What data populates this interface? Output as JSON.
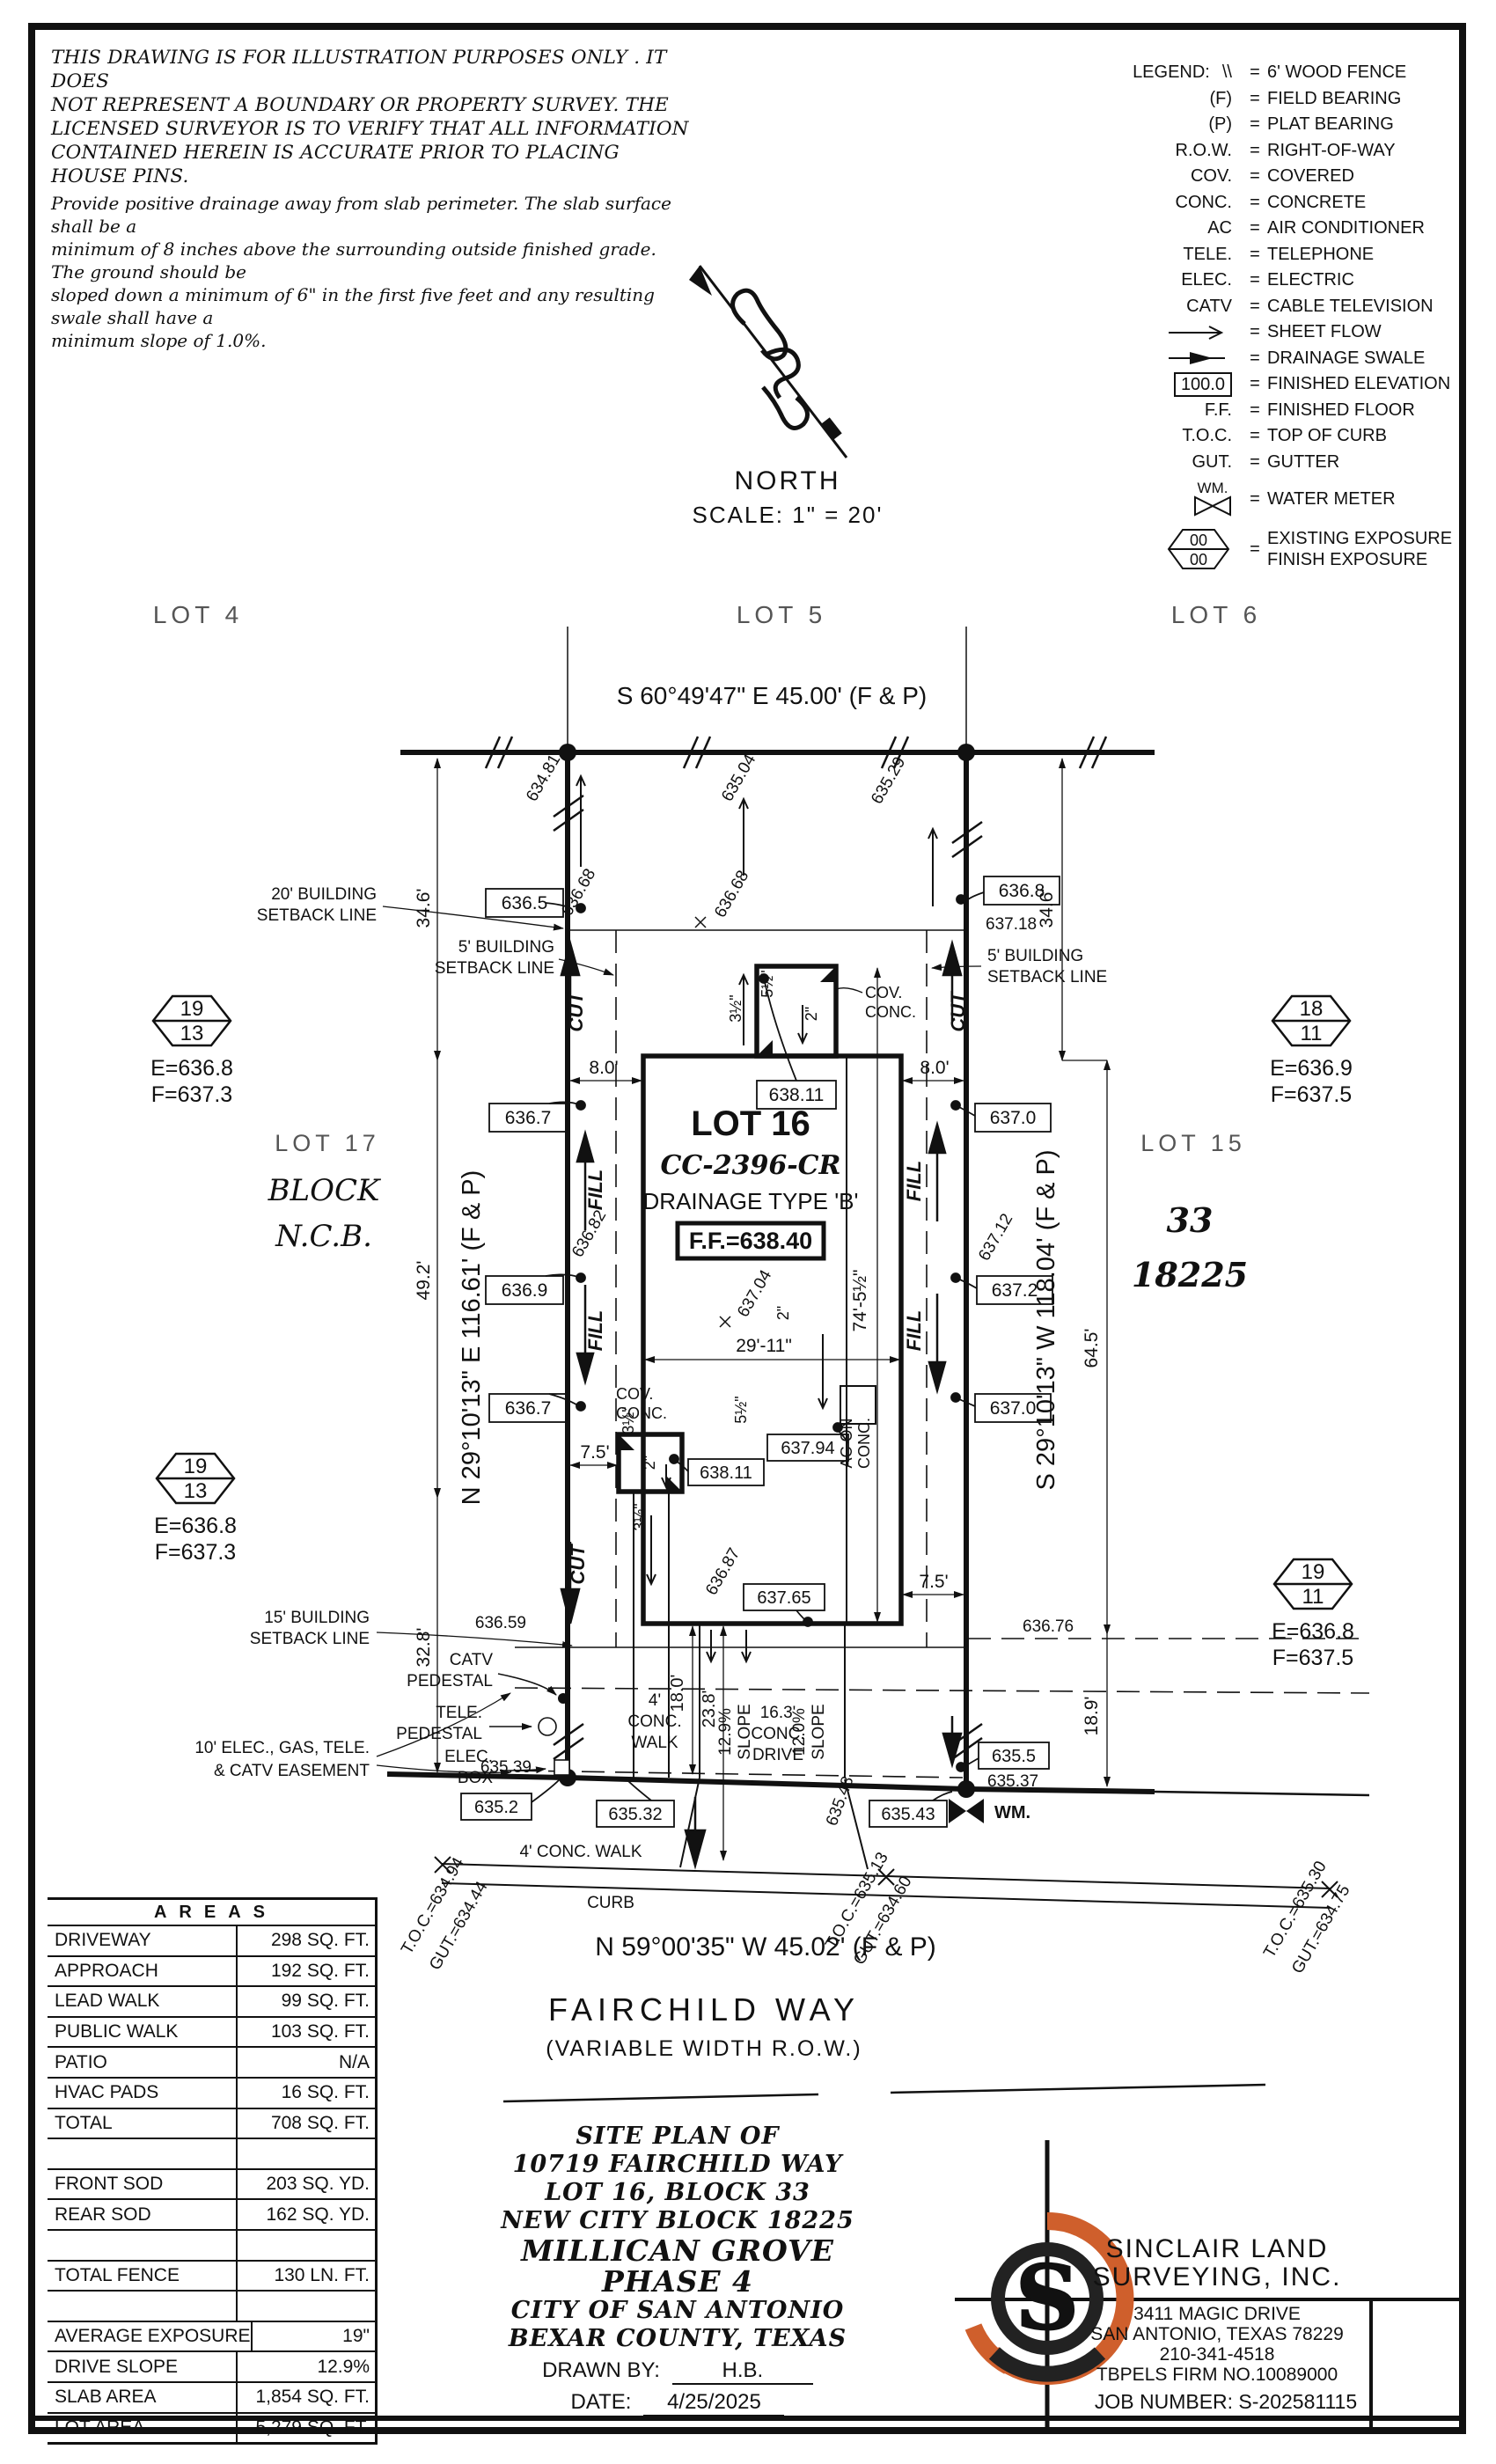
{
  "disclaimer": {
    "p1": [
      "THIS DRAWING IS FOR ILLUSTRATION PURPOSES ONLY . IT DOES",
      "NOT REPRESENT A BOUNDARY OR PROPERTY SURVEY. THE",
      "LICENSED SURVEYOR IS TO VERIFY THAT ALL INFORMATION",
      "CONTAINED HEREIN IS ACCURATE PRIOR TO PLACING HOUSE PINS."
    ],
    "p2": [
      "Provide positive drainage away from slab perimeter. The slab surface shall be a",
      "minimum of 8 inches above the surrounding outside finished grade. The ground should be",
      "sloped down a minimum of 6\" in the first five feet and any resulting swale shall have a",
      "minimum slope of 1.0%."
    ]
  },
  "legend": {
    "title": "LEGEND:",
    "eq": "=",
    "rows1": [
      {
        "sym": "\\\\",
        "desc": "6' WOOD FENCE"
      },
      {
        "sym": "(F)",
        "desc": "FIELD BEARING"
      },
      {
        "sym": "(P)",
        "desc": "PLAT BEARING"
      },
      {
        "sym": "R.O.W.",
        "desc": "RIGHT-OF-WAY"
      },
      {
        "sym": "COV.",
        "desc": "COVERED"
      },
      {
        "sym": "CONC.",
        "desc": "CONCRETE"
      },
      {
        "sym": "AC",
        "desc": "AIR CONDITIONER"
      },
      {
        "sym": "TELE.",
        "desc": "TELEPHONE"
      },
      {
        "sym": "ELEC.",
        "desc": "ELECTRIC"
      },
      {
        "sym": "CATV",
        "desc": "CABLE TELEVISION"
      }
    ],
    "flow_desc": "SHEET FLOW",
    "swale_desc": "DRAINAGE SWALE",
    "elev_sym": "100.0",
    "elev_desc": "FINISHED ELEVATION",
    "rows2": [
      {
        "sym": "F.F.",
        "desc": "FINISHED FLOOR"
      },
      {
        "sym": "T.O.C.",
        "desc": "TOP OF CURB"
      },
      {
        "sym": "GUT.",
        "desc": "GUTTER"
      }
    ],
    "wm_sym": "WM.",
    "wm_desc": "WATER METER",
    "hex_top": "00",
    "hex_bot": "00",
    "hex_desc1": "EXISTING EXPOSURE",
    "hex_desc2": "FINISH EXPOSURE"
  },
  "north": {
    "label": "NORTH",
    "scale": "SCALE: 1\" = 20'"
  },
  "adj": {
    "lot4": "LOT 4",
    "lot5": "LOT 5",
    "lot6": "LOT 6",
    "lot17": "LOT 17",
    "block": "BLOCK",
    "ncb": "N.C.B.",
    "lot15": "LOT 15",
    "b33": "33",
    "ncb2": "18225"
  },
  "brg": {
    "n": "S 60°49'47\" E 45.00' (F & P)",
    "w": "N 29°10'13\" E 116.61' (F & P)",
    "e": "S 29°10'13\" W 118.04' (F & P)",
    "s": "N 59°00'35\" W 45.02' (F & P)"
  },
  "hexm": {
    "nw": {
      "t": "19",
      "b": "13",
      "e": "E=636.8",
      "f": "F=637.3"
    },
    "ne": {
      "t": "18",
      "b": "11",
      "e": "E=636.9",
      "f": "F=637.5"
    },
    "sw": {
      "t": "19",
      "b": "13",
      "e": "E=636.8",
      "f": "F=637.3"
    },
    "se": {
      "t": "19",
      "b": "11",
      "e": "E=636.8",
      "f": "F=637.5"
    }
  },
  "lot": {
    "name": "LOT 16",
    "cc": "CC-2396-CR",
    "dr": "DRAINAGE TYPE 'B'",
    "ff": "F.F.=638.40"
  },
  "sb": {
    "b20": "20' BUILDING",
    "b5": "5' BUILDING",
    "b15": "15' BUILDING",
    "sl": "SETBACK LINE",
    "e1": "10' ELEC., GAS, TELE.",
    "e2": "& CATV EASEMENT"
  },
  "util": {
    "catv": "CATV",
    "ped": "PEDESTAL",
    "tele": "TELE.",
    "elec": "ELEC.",
    "box": "BOX",
    "wm": "WM."
  },
  "dims": {
    "d346": "34.6'",
    "d492": "49.2'",
    "d328": "32.8'",
    "d645": "64.5'",
    "d189": "18.9'",
    "d80": "8.0'",
    "d75": "7.5'",
    "hw": "29'-11\"",
    "hd": "74'-5½\"",
    "d180": "18.0'",
    "d238": "23.8'",
    "dr1": "16.3'",
    "dr2": "CONC.",
    "dr3": "DRIVE",
    "s129": "12.9%",
    "s120": "12.0%",
    "slw": "SLOPE",
    "w1": "4'",
    "w2": "CONC.",
    "w3": "WALK"
  },
  "sm": {
    "d2": "2\"",
    "d35": "3½\"",
    "d55": "5½\"",
    "cov": "COV.",
    "conc": "CONC.",
    "ac1": "AC ON",
    "ac2": "CONC."
  },
  "flow": {
    "cut": "CUT",
    "fill": "FILL"
  },
  "sp": {
    "e63481": "634.81",
    "e63504": "635.04",
    "e63529": "635.29",
    "e63668": "636.68",
    "e63682": "636.82",
    "e63712": "637.12",
    "e63704": "637.04",
    "e63687": "636.87",
    "e63548": "635.48",
    "e63659": "636.59",
    "e63676": "636.76",
    "e63718": "637.18",
    "e63539": "635.39",
    "e63537": "635.37"
  },
  "bx": {
    "b6365": "636.5",
    "b6367": "636.7",
    "b6369": "636.9",
    "b6368": "636.8",
    "b6370": "637.0",
    "b6372": "637.2",
    "b63811": "638.11",
    "b63794": "637.94",
    "b63765": "637.65",
    "b6352": "635.2",
    "b63532": "635.32",
    "b63543": "635.43",
    "b6355": "635.5"
  },
  "toc": {
    "t1a": "T.O.C.=634.94",
    "t1b": "GUT.=634.44",
    "t2a": "T.O.C.=635.13",
    "t2b": "GUT.=634.60",
    "t3a": "T.O.C.=635.30",
    "t3b": "GUT.=634.75"
  },
  "street": {
    "walk": "4' CONC. WALK",
    "curb": "CURB",
    "name": "FAIRCHILD WAY",
    "row": "(VARIABLE WIDTH R.O.W.)"
  },
  "title": {
    "l1": "SITE PLAN OF",
    "l2": "10719 FAIRCHILD WAY",
    "l3": "LOT 16, BLOCK 33",
    "l4": "NEW CITY BLOCK 18225",
    "l5": "MILLICAN GROVE",
    "l6": "PHASE 4",
    "l7": "CITY OF SAN ANTONIO",
    "l8": "BEXAR COUNTY, TEXAS",
    "drawn_label": "DRAWN BY:",
    "drawn": "H.B.",
    "date_label": "DATE:",
    "date": "4/25/2025"
  },
  "areas": {
    "title": "AREAS",
    "rows": [
      {
        "l": "DRIVEWAY",
        "v": "298 SQ. FT."
      },
      {
        "l": "APPROACH",
        "v": "192 SQ. FT."
      },
      {
        "l": "LEAD WALK",
        "v": "99 SQ. FT."
      },
      {
        "l": "PUBLIC WALK",
        "v": "103 SQ. FT."
      },
      {
        "l": "PATIO",
        "v": "N/A"
      },
      {
        "l": "HVAC PADS",
        "v": "16 SQ. FT."
      },
      {
        "l": "TOTAL",
        "v": "708 SQ. FT."
      },
      {
        "l": "",
        "v": ""
      },
      {
        "l": "FRONT SOD",
        "v": "203 SQ. YD."
      },
      {
        "l": "REAR SOD",
        "v": "162 SQ. YD."
      },
      {
        "l": "",
        "v": ""
      },
      {
        "l": "TOTAL FENCE",
        "v": "130 LN. FT."
      },
      {
        "l": "",
        "v": ""
      },
      {
        "l": "AVERAGE EXPOSURE",
        "v": "19\""
      },
      {
        "l": "DRIVE SLOPE",
        "v": "12.9%"
      },
      {
        "l": "SLAB AREA",
        "v": "1,854 SQ. FT."
      },
      {
        "l": "LOT AREA",
        "v": "5,279 SQ. FT."
      }
    ]
  },
  "company": {
    "n1": "SINCLAIR LAND",
    "n2": "SURVEYING, INC.",
    "a1": "3411 MAGIC DRIVE",
    "a2": "SAN ANTONIO, TEXAS 78229",
    "a3": "210-341-4518",
    "a4": "TBPELS FIRM NO.10089000",
    "job": "JOB NUMBER:  S-202581115",
    "s": "S"
  },
  "colors": {
    "accent": "#cf5f2c",
    "ink": "#111111"
  }
}
